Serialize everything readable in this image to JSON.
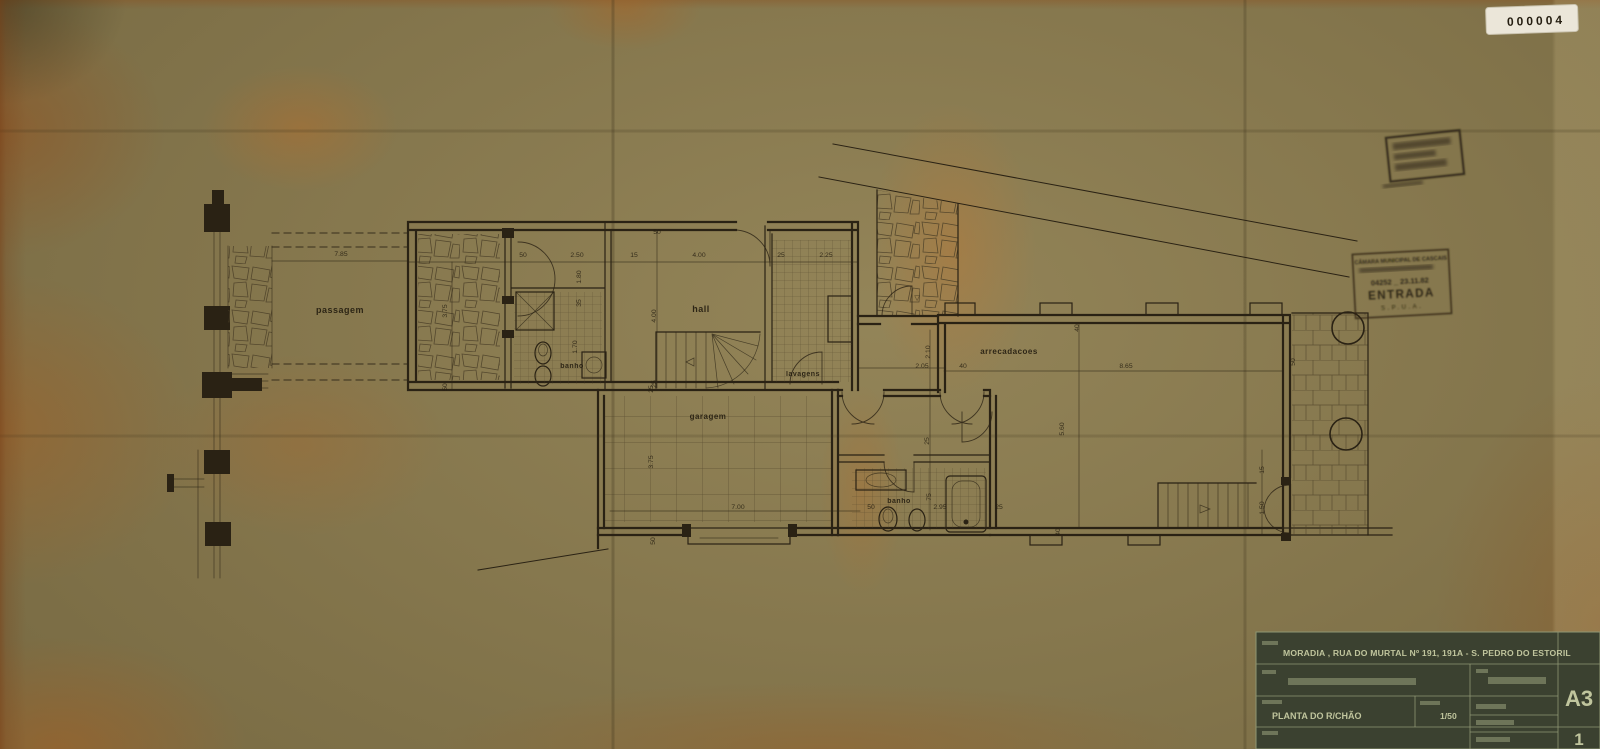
{
  "sticker": {
    "number": "000004"
  },
  "entry_stamp": {
    "line1": "CÂMARA MUNICIPAL DE CASCAIS",
    "number_date": "04252 _ 23.11.82",
    "word": "ENTRADA",
    "footer": "S.P.U.A."
  },
  "plan": {
    "rooms": {
      "passagem": "passagem",
      "banho_upper": "banho",
      "hall": "hall",
      "lavagens": "lavagens",
      "garagem": "garagem",
      "arrecadacoes": "arrecadacoes",
      "banho_lower": "banho"
    },
    "markers": {
      "level": "▽"
    },
    "dims": {
      "d01": "7.85",
      "d02": "3.75",
      "d03": "50",
      "d04": "50",
      "d05": "2.50",
      "d06": "15",
      "d07": "4.00",
      "d08": "25",
      "d09": "2.25",
      "d10": "50",
      "d11": "1.80",
      "d12": "35",
      "d13": "4.00",
      "d14": "1.70",
      "d15": "25",
      "d16": "2.10",
      "d17": "2.05",
      "d18": "40",
      "d19": "8.65",
      "d20": "40",
      "d21": "5.60",
      "d22": "3.75",
      "d23": "7.00",
      "d24": "50",
      "d25": "25",
      "d26": "50",
      "d27": "2.95",
      "d28": "25",
      "d29": "75",
      "d30": "25",
      "d31": "15",
      "d32": "1.50",
      "d33": "50",
      "d34": "40"
    }
  },
  "title_block": {
    "address": "MORADIA , RUA DO MURTAL Nº 191, 191A - S. PEDRO DO ESTORIL",
    "drawing_title": "PLANTA DO R/CHÃO",
    "scale_value": "1/50",
    "sheet_format": "A3",
    "sheet_number": "1"
  }
}
